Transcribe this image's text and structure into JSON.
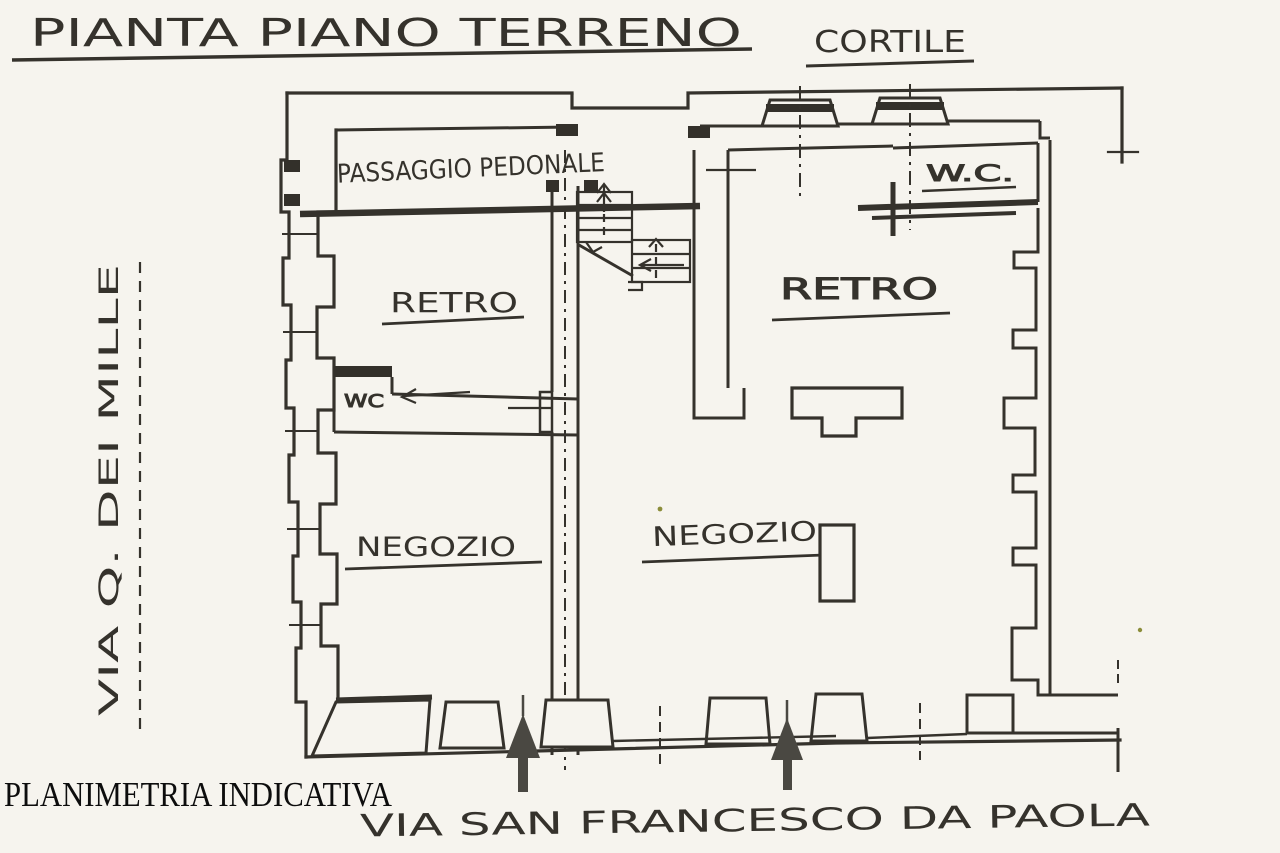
{
  "page": {
    "title": "PIANTA PIANO TERRENO",
    "watermark": "PLANIMETRIA INDICATIVA"
  },
  "courtyard_label": "CORTILE",
  "streets": {
    "left_vertical": "VIA Q. DEI MILLE",
    "bottom": "VIA SAN FRANCESCO DA PAOLA"
  },
  "rooms": {
    "passaggio_pedonale": "PASSAGGIO PEDONALE",
    "retro_left": "RETRO",
    "retro_right": "RETRO",
    "wc_left": "WC",
    "wc_right": "W.C.",
    "negozio_left": "NEGOZIO",
    "negozio_right": "NEGOZIO"
  },
  "colors": {
    "paper": "#f6f4ee",
    "ink": "#35322c",
    "ink_heavy": "#2b2823",
    "watermark_ink": "#0d0d0d",
    "speck": "#8b8d3a"
  }
}
